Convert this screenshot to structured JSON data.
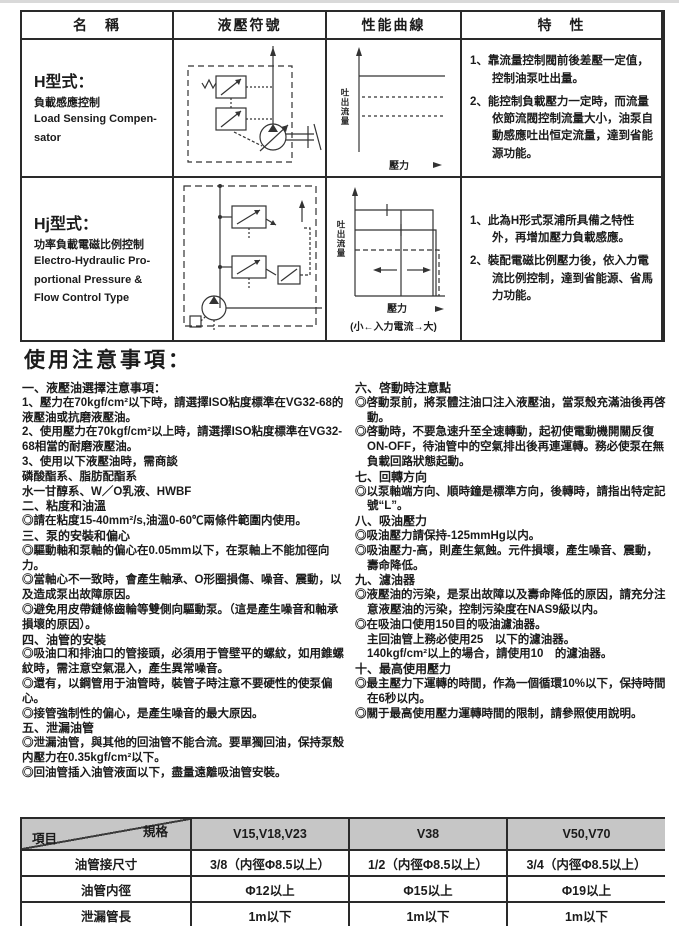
{
  "top_table": {
    "headers": [
      "名　稱",
      "液壓符號",
      "性能曲線",
      "特　性"
    ],
    "rows": [
      {
        "name_title": "H型式：",
        "name_sub": "負載感應控制",
        "name_en": [
          "Load Sensing Compen-",
          "sator"
        ],
        "curve": {
          "ylabel": "吐出流量",
          "xlabel": "壓力"
        },
        "features": [
          "1、靠流量控制閥前後差壓一定值，控制油泵吐出量。",
          "2、能控制負載壓力一定時，而流量依節流閥控制流量大小，油泵自動感應吐出恒定流量，達到省能源功能。"
        ]
      },
      {
        "name_title": "Hj型式：",
        "name_sub": "功率負載電磁比例控制",
        "name_en": [
          "Electro-Hydraulic Pro-",
          "portional Pressure &",
          "Flow Control Type"
        ],
        "curve": {
          "ylabel": "吐出流量",
          "xlabel": "壓力",
          "caption": "(小←入力電流→大)"
        },
        "features": [
          "1、此為H形式泵浦所具備之特性外，再增加壓力負載感應。",
          "2、裝配電磁比例壓力後，依入力電流比例控制，達到省能源、省馬力功能。"
        ]
      }
    ]
  },
  "notes": {
    "title": "使用注意事項：",
    "left": [
      {
        "t": "h",
        "x": "一、液壓油選擇注意事項："
      },
      {
        "t": "p",
        "x": "1、壓力在70kgf/cm²以下時，請選擇ISO粘度標準在VG32-68的液壓油或抗磨液壓油。"
      },
      {
        "t": "p",
        "x": "2、使用壓力在70kgf/cm²以上時，請選擇ISO粘度標準在VG32-68相當的耐磨液壓油。"
      },
      {
        "t": "p",
        "x": "3、使用以下液壓油時，需商談"
      },
      {
        "t": "p",
        "x": "磷酸酯系、脂肪配酯系"
      },
      {
        "t": "p",
        "x": "水一甘醇系、W／O乳液、HWBF"
      },
      {
        "t": "h",
        "x": "二、粘度和油溫"
      },
      {
        "t": "p",
        "x": "◎請在粘度15-40mm²/s,油溫0-60℃兩條件範圍内使用。"
      },
      {
        "t": "h",
        "x": "三、泵的安裝和偏心"
      },
      {
        "t": "p",
        "x": "◎驅動軸和泵軸的偏心在0.05mm以下，在泵軸上不能加徑向力。"
      },
      {
        "t": "p",
        "x": "◎當軸心不一致時，會產生軸承、O形圈損傷、噪音、震動，以及造成泵出故障原因。"
      },
      {
        "t": "p",
        "x": "◎避免用皮帶鏈條齒輪等雙側向驅動泵。（這是產生噪音和軸承損壞的原因）。"
      },
      {
        "t": "h",
        "x": "四、油管的安裝"
      },
      {
        "t": "p",
        "x": "◎吸油口和排油口的管接頭，必須用于管壁平的螺紋，如用錐螺紋時，需注意空氣混入，產生異常噪音。"
      },
      {
        "t": "p",
        "x": "◎還有，以鋼管用于油管時，裝管子時注意不要硬性的使泵偏心。"
      },
      {
        "t": "p",
        "x": "◎接管強制性的偏心，是產生噪音的最大原因。"
      },
      {
        "t": "h",
        "x": "五、泄漏油管"
      },
      {
        "t": "p",
        "x": "◎泄漏油管，與其他的回油管不能合流。要單獨回油，保持泵殼内壓力在0.35kgf/cm²以下。"
      },
      {
        "t": "p",
        "x": "◎回油管插入油管液面以下，盡量遠離吸油管安裝。"
      }
    ],
    "right": [
      {
        "t": "h",
        "x": "六、啓動時注意點"
      },
      {
        "t": "i",
        "x": "◎啓動泵前，將泵體注油口注入液壓油，當泵殼充滿油後再啓動。"
      },
      {
        "t": "i",
        "x": "◎啓動時，不要急速升至全速轉動，起初使電動機開關反復ON-OFF，待油管中的空氣排出後再連運轉。務必使泵在無負載回路狀態起動。"
      },
      {
        "t": "h",
        "x": "七、回轉方向"
      },
      {
        "t": "i",
        "x": "◎以泵軸端方向、順時鐘是標準方向，後轉時，請指出特定記號“L”。"
      },
      {
        "t": "h",
        "x": "八、吸油壓力"
      },
      {
        "t": "i",
        "x": "◎吸油壓力請保持-125mmHg以内。"
      },
      {
        "t": "i",
        "x": "◎吸油壓力-高，則產生氣蝕。元件損壞，產生噪音、震動，壽命降低。"
      },
      {
        "t": "h",
        "x": "九、濾油器"
      },
      {
        "t": "i",
        "x": "◎液壓油的污染，是泵出故障以及壽命降低的原因，請充分注意液壓油的污染，控制污染度在NAS9級以内。"
      },
      {
        "t": "i",
        "x": "◎在吸油口使用150目的吸油濾油器。"
      },
      {
        "t": "c",
        "x": "主回油管上務必使用25　以下的濾油器。"
      },
      {
        "t": "c",
        "x": "140kgf/cm²以上的場合，請使用10　的濾油器。"
      },
      {
        "t": "h",
        "x": "十、最高使用壓力"
      },
      {
        "t": "i",
        "x": "◎最主壓力下運轉的時間，作為一個循環10%以下，保持時間在6秒以内。"
      },
      {
        "t": "i",
        "x": "◎關于最高使用壓力運轉時間的限制，請參照使用說明。"
      }
    ]
  },
  "spec_table": {
    "corner": {
      "top": "規格",
      "bottom": "項目"
    },
    "columns": [
      "V15,V18,V23",
      "V38",
      "V50,V70"
    ],
    "rows": [
      {
        "label": "油管接尺寸",
        "values": [
          "3/8（内徑Φ8.5以上）",
          "1/2（内徑Φ8.5以上）",
          "3/4（内徑Φ8.5以上）"
        ]
      },
      {
        "label": "油管内徑",
        "values": [
          "Φ12以上",
          "Φ15以上",
          "Φ19以上"
        ]
      },
      {
        "label": "泄漏管長",
        "values": [
          "1m以下",
          "1m以下",
          "1m以下"
        ]
      }
    ]
  }
}
